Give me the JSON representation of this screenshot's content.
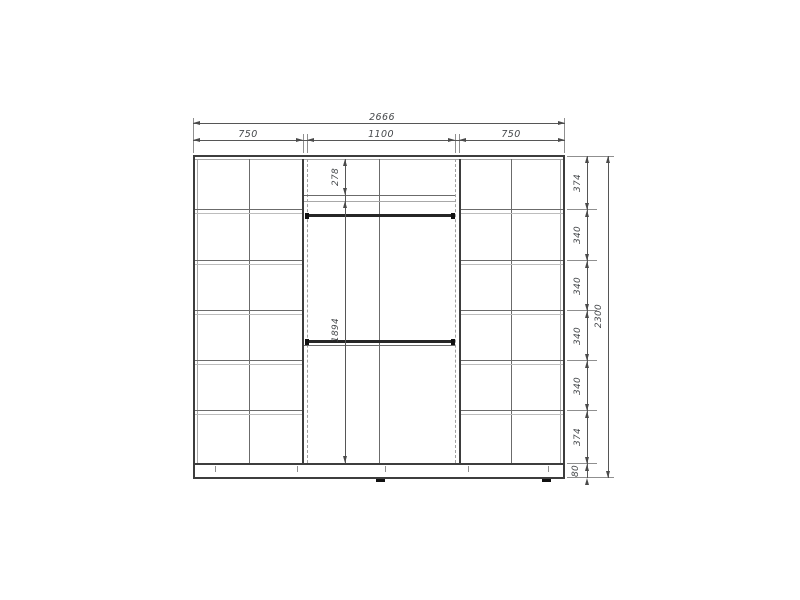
{
  "dims": {
    "total_width": "2666",
    "section_left": "750",
    "section_middle": "1100",
    "section_right": "750",
    "total_height": "2300",
    "rows": [
      "374",
      "340",
      "340",
      "340",
      "340",
      "374"
    ],
    "plinth": "80",
    "top_shelf_height": "278",
    "opening_height": "1894"
  }
}
